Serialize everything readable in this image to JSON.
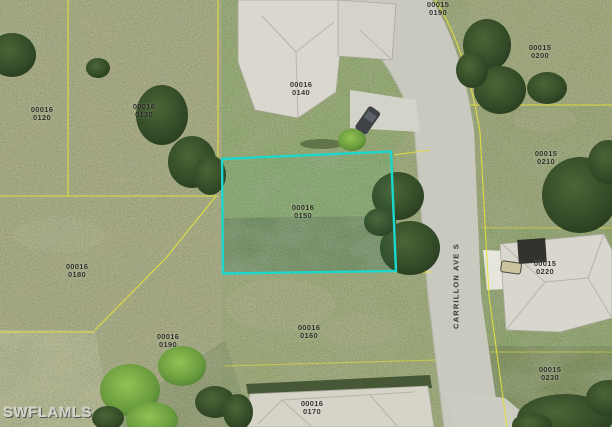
{
  "map": {
    "watermark": "SWFLAMLS",
    "street": {
      "name": "CARRILLON AVE S"
    },
    "colors": {
      "highlight_border": "#1bd7cc",
      "parcel_line": "#e4e13c",
      "road": "#c9c9c0"
    },
    "highlighted_parcel": {
      "block": "00016",
      "lot": "0150"
    },
    "parcel_labels": [
      {
        "block": "00016",
        "lot": "0120",
        "x": 42,
        "y": 114,
        "highlighted": false
      },
      {
        "block": "00016",
        "lot": "0130",
        "x": 144,
        "y": 111,
        "highlighted": false
      },
      {
        "block": "00016",
        "lot": "0140",
        "x": 301,
        "y": 89,
        "highlighted": false
      },
      {
        "block": "00016",
        "lot": "0150",
        "x": 303,
        "y": 212,
        "highlighted": true
      },
      {
        "block": "00016",
        "lot": "0180",
        "x": 77,
        "y": 271,
        "highlighted": false
      },
      {
        "block": "00016",
        "lot": "0190",
        "x": 168,
        "y": 341,
        "highlighted": false
      },
      {
        "block": "00016",
        "lot": "0160",
        "x": 309,
        "y": 332,
        "highlighted": false
      },
      {
        "block": "00016",
        "lot": "0170",
        "x": 312,
        "y": 408,
        "highlighted": false
      },
      {
        "block": "00015",
        "lot": "0190",
        "x": 438,
        "y": 9,
        "highlighted": false
      },
      {
        "block": "00015",
        "lot": "0200",
        "x": 540,
        "y": 52,
        "highlighted": false
      },
      {
        "block": "00015",
        "lot": "0210",
        "x": 546,
        "y": 158,
        "highlighted": false
      },
      {
        "block": "00015",
        "lot": "0220",
        "x": 545,
        "y": 268,
        "highlighted": false
      },
      {
        "block": "00015",
        "lot": "0230",
        "x": 550,
        "y": 374,
        "highlighted": false
      }
    ]
  }
}
